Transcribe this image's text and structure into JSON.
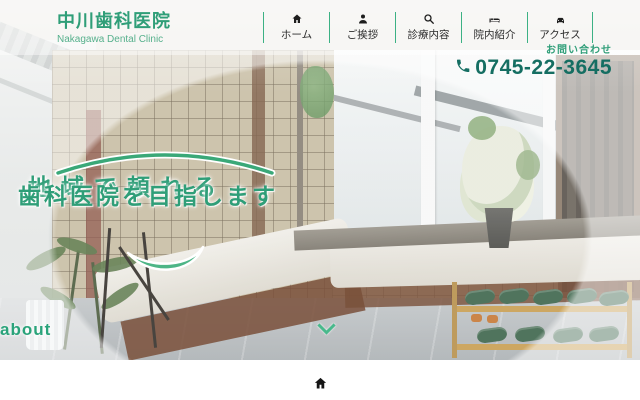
{
  "brand": {
    "name": "中川歯科医院",
    "name_en": "Nakagawa Dental Clinic"
  },
  "nav": {
    "items": [
      {
        "label": "ホーム",
        "icon": "home-icon"
      },
      {
        "label": "ご挨拶",
        "icon": "person-icon"
      },
      {
        "label": "診療内容",
        "icon": "search-icon"
      },
      {
        "label": "院内紹介",
        "icon": "clinic-icon"
      },
      {
        "label": "アクセス",
        "icon": "car-icon"
      }
    ]
  },
  "contact": {
    "label": "お問い合わせ",
    "phone": "0745-22-3645"
  },
  "hero": {
    "headline_line1": "地域で頼れる",
    "headline_line2": "歯科医院を目指します",
    "scroll_label": "about",
    "photo_description": "dental clinic waiting room with tiled wall, windows, bench and slipper rack"
  },
  "section": {
    "title": "HOME"
  },
  "colors": {
    "brand_green": "#2f9e78",
    "accent_green": "#3cb184",
    "light_green": "#4db586",
    "phone_teal": "#156e62",
    "nav_text": "#2b2b2b"
  }
}
